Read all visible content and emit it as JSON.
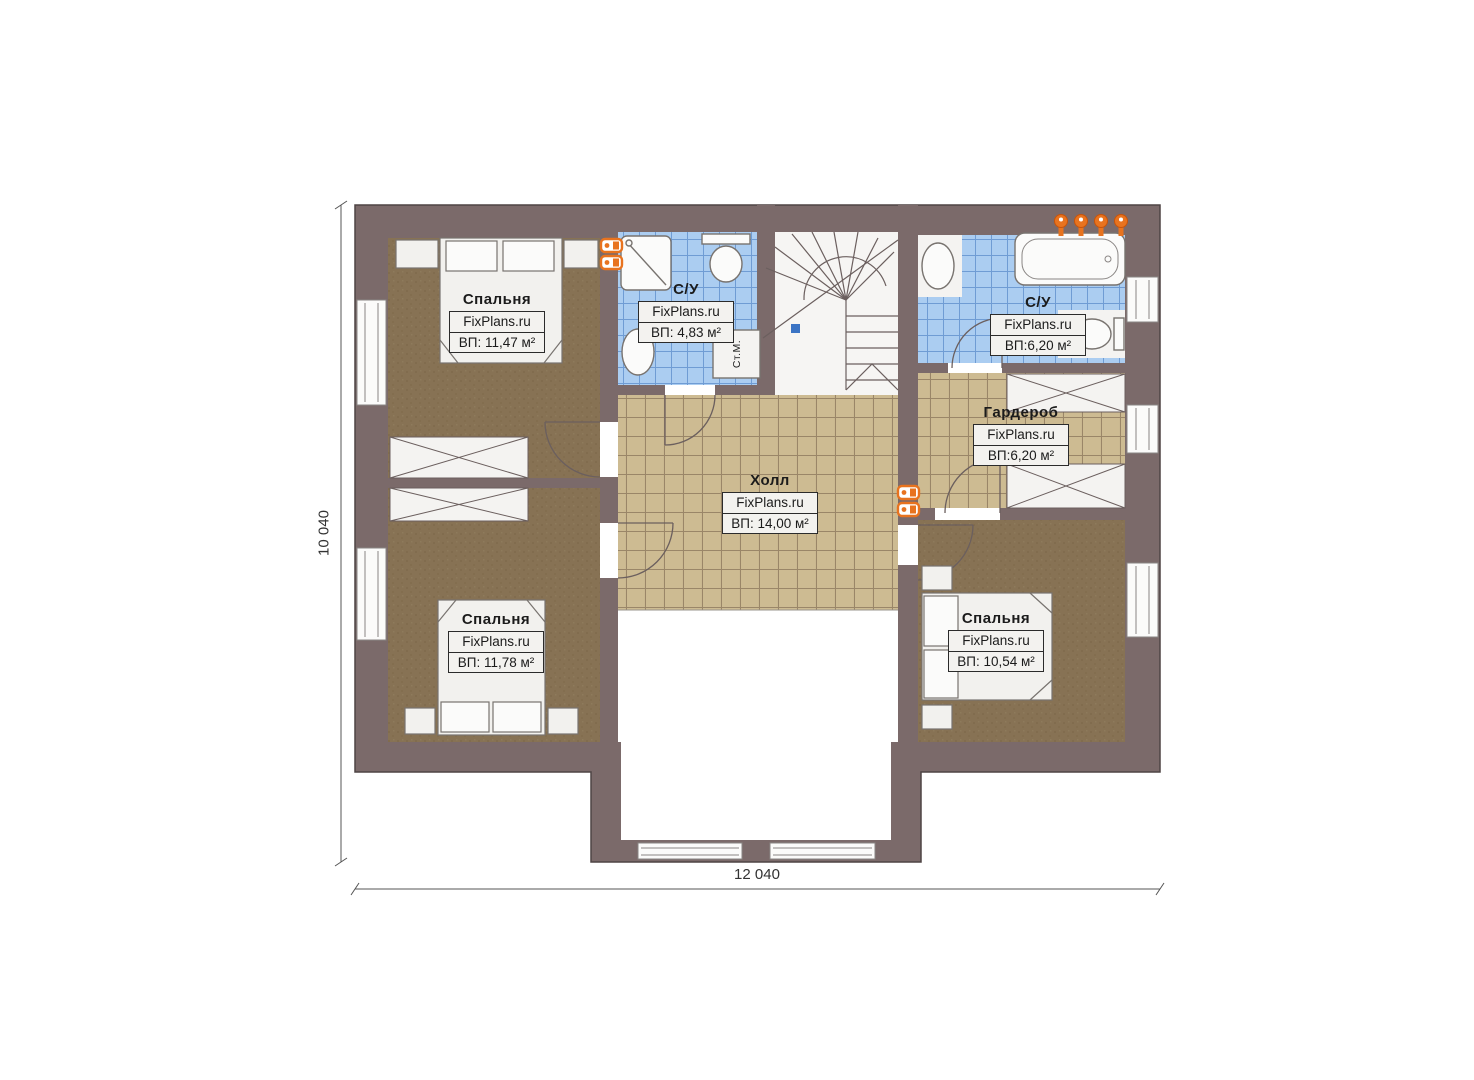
{
  "plan": {
    "type": "floor-plan",
    "site": "FixPlans.ru"
  },
  "dimensions": {
    "height_label": "10 040",
    "width_label": "12 040"
  },
  "rooms": [
    {
      "id": "bedroom-top-left",
      "title": "Спальня",
      "brand": "FixPlans.ru",
      "area": "ВП: 11,47 м²"
    },
    {
      "id": "bathroom-left",
      "title": "С/У",
      "brand": "FixPlans.ru",
      "area": "ВП: 4,83 м²"
    },
    {
      "id": "bathroom-right",
      "title": "С/У",
      "brand": "FixPlans.ru",
      "area": "ВП:6,20 м²"
    },
    {
      "id": "wardrobe",
      "title": "Гардероб",
      "brand": "FixPlans.ru",
      "area": "ВП:6,20 м²"
    },
    {
      "id": "hall",
      "title": "Холл",
      "brand": "FixPlans.ru",
      "area": "ВП: 14,00 м²"
    },
    {
      "id": "bedroom-bottom-left",
      "title": "Спальня",
      "brand": "FixPlans.ru",
      "area": "ВП: 11,78 м²"
    },
    {
      "id": "bedroom-bottom-right",
      "title": "Спальня",
      "brand": "FixPlans.ru",
      "area": "ВП: 10,54 м²"
    }
  ],
  "fixtures": {
    "washing_machine_label": "Ст.М."
  },
  "colors": {
    "wall": "#7b6a6a",
    "wall_outline": "#4e4444",
    "bedroom_floor": "#877254",
    "bedroom_floor_dark": "#7c6848",
    "tile_beige": "#cdbb92",
    "tile_beige_line": "#9a8668",
    "tile_blue": "#abcdf1",
    "tile_blue_line": "#6f9cd4",
    "furniture_fill": "#f2f1ee",
    "furniture_line": "#78736f",
    "radiator": "#e8731f",
    "stair_marker": "#3b74c4",
    "label_box_bg": "#f3f2ef",
    "label_border": "#2b2b2b",
    "text": "#1b1b1b",
    "dim_line": "#555555",
    "stair_line": "#6b5f5e"
  }
}
